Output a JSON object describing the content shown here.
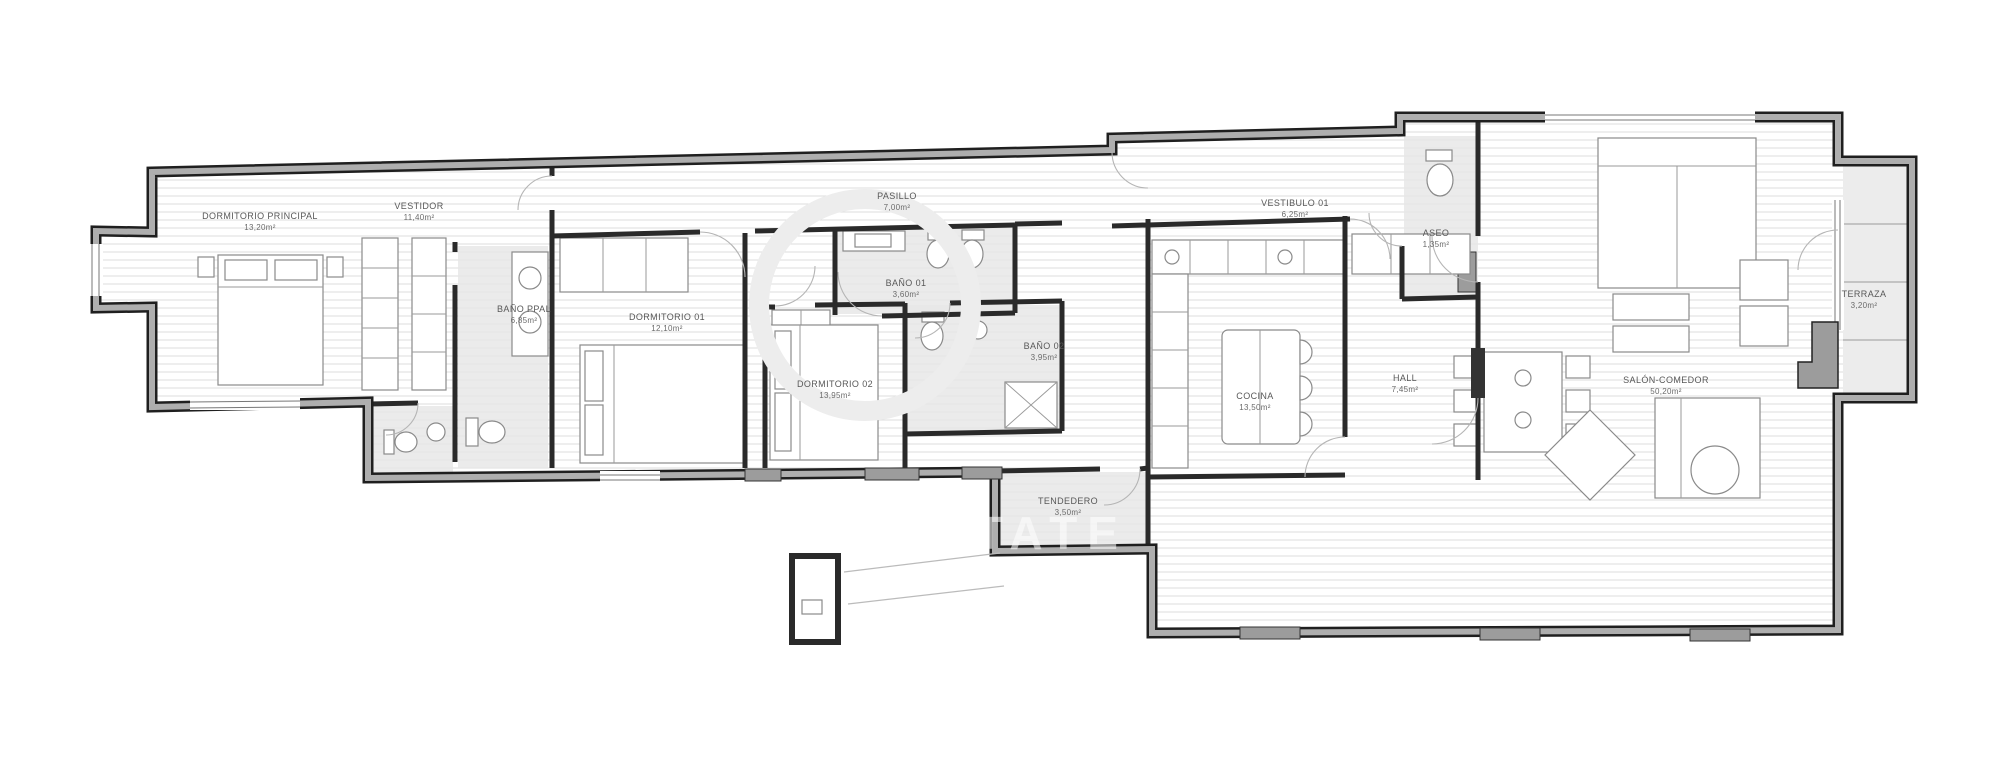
{
  "meta": {
    "kind": "apartment-floor-plan",
    "language": "es"
  },
  "colors": {
    "wall_edge": "#1f1f1f",
    "wall_core": "#aeaeae",
    "floor_hatch": "#dcdcdc",
    "bath_floor": "#e7e7e7",
    "label_text": "#585858",
    "background": "#ffffff"
  },
  "watermark": {
    "text": "ESTATE"
  },
  "rooms": [
    {
      "id": "dormitorio-principal",
      "name": "DORMITORIO PRINCIPAL",
      "area": "13,20m²"
    },
    {
      "id": "vestidor",
      "name": "VESTIDOR",
      "area": "11,40m²"
    },
    {
      "id": "bano-ppal",
      "name": "BAÑO PPAL",
      "area": "6,85m²"
    },
    {
      "id": "dormitorio-01",
      "name": "DORMITORIO 01",
      "area": "12,10m²"
    },
    {
      "id": "pasillo",
      "name": "PASILLO",
      "area": "7,00m²"
    },
    {
      "id": "bano-01",
      "name": "BAÑO 01",
      "area": "3,60m²"
    },
    {
      "id": "dormitorio-02",
      "name": "DORMITORIO 02",
      "area": "13,95m²"
    },
    {
      "id": "bano-02",
      "name": "BAÑO 02",
      "area": "3,95m²"
    },
    {
      "id": "vestibulo-01",
      "name": "VESTIBULO 01",
      "area": "6,25m²"
    },
    {
      "id": "aseo",
      "name": "ASEO",
      "area": "1,35m²"
    },
    {
      "id": "cocina",
      "name": "COCINA",
      "area": "13,50m²"
    },
    {
      "id": "hall",
      "name": "HALL",
      "area": "7,45m²"
    },
    {
      "id": "salon-comedor",
      "name": "SALÓN-COMEDOR",
      "area": "50,20m²"
    },
    {
      "id": "terraza",
      "name": "TERRAZA",
      "area": "3,20m²"
    },
    {
      "id": "tendedero",
      "name": "TENDEDERO",
      "area": "3,50m²"
    }
  ]
}
